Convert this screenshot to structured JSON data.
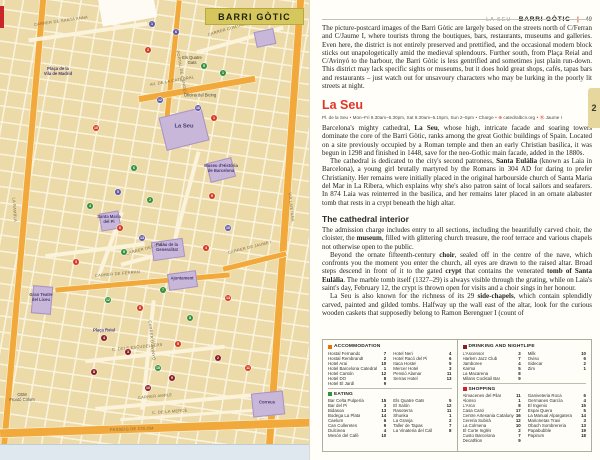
{
  "header": {
    "section": "LA SEU",
    "chapter": "BARRI GÒTIC",
    "divider": "|",
    "page_number": "49"
  },
  "chapter_tab": "2",
  "map": {
    "banner": "BARRI GÒTIC",
    "colors": {
      "acc": "#d6391f",
      "eat": "#35903b",
      "drink": "#8c1d25",
      "shop": "#5f58a6"
    },
    "roads": [
      {
        "x": 20,
        "y": -10,
        "w": 6,
        "h": 480,
        "r": 5,
        "c": "o"
      },
      {
        "x": 281,
        "y": -10,
        "w": 7,
        "h": 480,
        "r": 4,
        "c": "o"
      },
      {
        "x": 170,
        "y": 0,
        "w": 5,
        "h": 130,
        "r": 6,
        "c": "o"
      },
      {
        "x": 0,
        "y": 424,
        "w": 310,
        "h": 8,
        "r": -2,
        "c": "o"
      },
      {
        "x": 138,
        "y": 86,
        "w": 118,
        "h": 6,
        "r": -10,
        "c": "o"
      },
      {
        "x": 55,
        "y": 280,
        "w": 175,
        "h": 4.5,
        "r": -5,
        "c": "o"
      },
      {
        "x": 222,
        "y": 259,
        "w": 65,
        "h": 4.5,
        "r": -14,
        "c": "o"
      },
      {
        "x": 28,
        "y": 30,
        "w": 120,
        "h": 4,
        "r": -8,
        "c": "w"
      },
      {
        "x": 195,
        "y": 38,
        "w": 90,
        "h": 4,
        "r": -16,
        "c": "w"
      },
      {
        "x": 45,
        "y": 248,
        "w": 100,
        "h": 3.5,
        "r": -7,
        "c": "w"
      },
      {
        "x": 146,
        "y": 300,
        "w": 3.5,
        "h": 110,
        "r": 6,
        "c": "w"
      },
      {
        "x": 85,
        "y": 352,
        "w": 140,
        "h": 3.5,
        "r": -6,
        "c": "w"
      },
      {
        "x": 95,
        "y": 400,
        "w": 160,
        "h": 3.5,
        "r": -5,
        "c": "w"
      },
      {
        "x": 108,
        "y": 210,
        "w": 3.5,
        "h": 70,
        "r": 20,
        "c": "w"
      },
      {
        "x": 120,
        "y": 255,
        "w": 60,
        "h": 3.5,
        "r": -15,
        "c": "w"
      },
      {
        "x": 185,
        "y": 150,
        "w": 3.5,
        "h": 90,
        "r": 15,
        "c": "w"
      },
      {
        "x": 120,
        "y": 413,
        "w": 150,
        "h": 3,
        "r": -4,
        "c": "w"
      }
    ],
    "landmark_blocks": [
      {
        "x": 162,
        "y": 112,
        "w": 42,
        "h": 32,
        "r": -14
      },
      {
        "x": 152,
        "y": 240,
        "w": 30,
        "h": 17,
        "r": -8
      },
      {
        "x": 168,
        "y": 272,
        "w": 27,
        "h": 15,
        "r": -8
      },
      {
        "x": 32,
        "y": 286,
        "w": 18,
        "h": 26,
        "r": 5
      },
      {
        "x": 208,
        "y": 160,
        "w": 24,
        "h": 18,
        "r": -14
      },
      {
        "x": 100,
        "y": 212,
        "w": 18,
        "h": 16,
        "r": -10
      },
      {
        "x": 252,
        "y": 392,
        "w": 30,
        "h": 22,
        "r": -6
      },
      {
        "x": 255,
        "y": 30,
        "w": 18,
        "h": 14,
        "r": -12
      }
    ],
    "street_labels": [
      {
        "t": "CARRER DE SANTA ANNA",
        "x": 34,
        "y": 22,
        "r": -8
      },
      {
        "t": "CARRER COMTAL",
        "x": 208,
        "y": 32,
        "r": -16
      },
      {
        "t": "AV. DE LA CATEDRAL",
        "x": 150,
        "y": 82,
        "r": -10
      },
      {
        "t": "PORTAL DE L'ÀNGEL",
        "x": 178,
        "y": 48,
        "r": 80
      },
      {
        "t": "VIA LAIETANA",
        "x": 290,
        "y": 190,
        "r": 84
      },
      {
        "t": "LA RAMBLA",
        "x": 14,
        "y": 195,
        "r": 86
      },
      {
        "t": "CARRER DE FERRAN",
        "x": 95,
        "y": 273,
        "r": -5
      },
      {
        "t": "CARRER DE JAUME I",
        "x": 228,
        "y": 250,
        "r": -14
      },
      {
        "t": "CARRER D'AVINYÓ",
        "x": 150,
        "y": 318,
        "r": 84
      },
      {
        "t": "C. DELS ESCUDELLERS",
        "x": 112,
        "y": 347,
        "r": -6
      },
      {
        "t": "CARRER AMPLE",
        "x": 138,
        "y": 395,
        "r": -5
      },
      {
        "t": "C. DE LA MERCÈ",
        "x": 152,
        "y": 410,
        "r": -4
      },
      {
        "t": "CARRER DEL CALL",
        "x": 126,
        "y": 251,
        "r": -15
      },
      {
        "t": "PASSEIG DE COLOM",
        "x": 110,
        "y": 427,
        "r": -2
      }
    ],
    "poi_labels": [
      {
        "t": "La Seu",
        "x": 184,
        "y": 127,
        "cls": "poi-big"
      },
      {
        "t": "Palau de la\nGeneralitat",
        "x": 167,
        "y": 248
      },
      {
        "t": "Ajuntament",
        "x": 182,
        "y": 279
      },
      {
        "t": "Gran Teatre\ndel Liceu",
        "x": 41,
        "y": 298
      },
      {
        "t": "Museu d'Història\nde Barcelona",
        "x": 221,
        "y": 169
      },
      {
        "t": "Santa Maria\ndel Pi",
        "x": 109,
        "y": 220
      },
      {
        "t": "Plaça Reial",
        "x": 104,
        "y": 331
      },
      {
        "t": "Correus",
        "x": 267,
        "y": 403
      },
      {
        "t": "Plaça de la\nVila de Madrid",
        "x": 58,
        "y": 72
      },
      {
        "t": "Els Quatre\nGats",
        "x": 192,
        "y": 61,
        "cls": "poi-plain"
      },
      {
        "t": "Oficina del Bicing",
        "x": 200,
        "y": 96,
        "cls": "poi-plain"
      },
      {
        "t": "CEM\nFrontó Colom",
        "x": 22,
        "y": 398,
        "cls": "poi-plain"
      }
    ],
    "markers": [
      {
        "n": "1",
        "x": 152,
        "y": 24,
        "c": "shop"
      },
      {
        "n": "6",
        "x": 176,
        "y": 32,
        "c": "shop"
      },
      {
        "n": "2",
        "x": 148,
        "y": 50,
        "c": "acc"
      },
      {
        "n": "5",
        "x": 204,
        "y": 66,
        "c": "eat"
      },
      {
        "n": "1",
        "x": 223,
        "y": 73,
        "c": "eat"
      },
      {
        "n": "12",
        "x": 160,
        "y": 100,
        "c": "shop"
      },
      {
        "n": "10",
        "x": 96,
        "y": 128,
        "c": "acc"
      },
      {
        "n": "1",
        "x": 214,
        "y": 118,
        "c": "acc"
      },
      {
        "n": "16",
        "x": 198,
        "y": 108,
        "c": "shop"
      },
      {
        "n": "6",
        "x": 134,
        "y": 168,
        "c": "eat"
      },
      {
        "n": "4",
        "x": 90,
        "y": 206,
        "c": "eat"
      },
      {
        "n": "5",
        "x": 118,
        "y": 192,
        "c": "shop"
      },
      {
        "n": "2",
        "x": 150,
        "y": 200,
        "c": "eat"
      },
      {
        "n": "9",
        "x": 212,
        "y": 196,
        "c": "acc"
      },
      {
        "n": "13",
        "x": 142,
        "y": 238,
        "c": "shop"
      },
      {
        "n": "6",
        "x": 120,
        "y": 228,
        "c": "acc"
      },
      {
        "n": "9",
        "x": 124,
        "y": 252,
        "c": "eat"
      },
      {
        "n": "4",
        "x": 206,
        "y": 248,
        "c": "acc"
      },
      {
        "n": "10",
        "x": 228,
        "y": 228,
        "c": "shop"
      },
      {
        "n": "7",
        "x": 163,
        "y": 290,
        "c": "eat"
      },
      {
        "n": "3",
        "x": 76,
        "y": 262,
        "c": "acc"
      },
      {
        "n": "8",
        "x": 140,
        "y": 308,
        "c": "acc"
      },
      {
        "n": "12",
        "x": 108,
        "y": 300,
        "c": "eat"
      },
      {
        "n": "4",
        "x": 104,
        "y": 338,
        "c": "drink"
      },
      {
        "n": "3",
        "x": 128,
        "y": 352,
        "c": "drink"
      },
      {
        "n": "8",
        "x": 190,
        "y": 318,
        "c": "eat"
      },
      {
        "n": "5",
        "x": 178,
        "y": 344,
        "c": "acc"
      },
      {
        "n": "13",
        "x": 228,
        "y": 298,
        "c": "acc"
      },
      {
        "n": "2",
        "x": 218,
        "y": 358,
        "c": "drink"
      },
      {
        "n": "9",
        "x": 172,
        "y": 378,
        "c": "drink"
      },
      {
        "n": "8",
        "x": 94,
        "y": 372,
        "c": "drink"
      },
      {
        "n": "15",
        "x": 158,
        "y": 368,
        "c": "eat"
      },
      {
        "n": "11",
        "x": 248,
        "y": 368,
        "c": "acc"
      },
      {
        "n": "10",
        "x": 148,
        "y": 388,
        "c": "drink"
      }
    ]
  },
  "article": {
    "intro": "The picture-postcard images of the Barri Gòtic are largely based on the streets north of C/Ferran and C/Jaume I, where tourists throng the boutiques, bars, restaurants, museums and galleries. Even here, the district is not entirely preserved and prettified, and the occasional modern block sticks out unapologetically amid the medieval splendours. Further south, from Plaça Reial and C/Avinyó to the harbour, the Barri Gòtic is less gentrified and sometimes just plain run-down. This district may lack specific sights or museums, but it does hold great shops, cafés, tapas bars and restaurants – just watch out for unsavoury characters who may be lurking in the poorly lit streets at night.",
    "heading": "La Seu",
    "info_line": [
      {
        "t": "Pl. de la Seu"
      },
      {
        "t": "Mon–Fri 9.30am–6.30pm, Sat 9.30am–5.15pm, Sun 2–5pm"
      },
      {
        "t": "Charge"
      },
      {
        "t": "catedralbcn.org",
        "icon": "⊕"
      },
      {
        "t": "Jaume I",
        "icon": "Ⓜ"
      }
    ],
    "paragraphs": [
      {
        "segments": [
          {
            "t": "Barcelona's mighty cathedral, "
          },
          {
            "t": "La Seu",
            "b": true
          },
          {
            "t": ", whose high, intricate facade and soaring towers dominate the core of the Barri Gòtic, ranks among the great Gothic buildings of Spain. Located on a site previously occupied by a Roman temple and then an early Christian basilica, it was begun in 1298 and finished in 1448, save for the neo-Gothic main facade, added in the 1880s."
          }
        ]
      },
      {
        "segments": [
          {
            "t": "The cathedral is dedicated to the city's second patroness, "
          },
          {
            "t": "Santa Eulàlia",
            "b": true
          },
          {
            "t": " (known as Laia in Barcelona), a young girl brutally martyred by the Romans in 304 AD for daring to prefer Christianity. Her remains were initially placed in the original harbourside church of Santa Maria del Mar in La Ribera, which explains why she's also patron saint of local sailors and seafarers. In 874 Laia was reinterred in the basilica, and her remains later placed in an ornate alabaster tomb that rests in a crypt beneath the high altar."
          }
        ]
      }
    ],
    "subheading": "The cathedral interior",
    "interior_paragraphs": [
      {
        "segments": [
          {
            "t": "The admission charge includes entry to all sections, including the beautifully carved choir, the cloister, the "
          },
          {
            "t": "museum",
            "b": true
          },
          {
            "t": ", filled with glittering church treasure, the roof terrace and various chapels not otherwise open to the public."
          }
        ]
      },
      {
        "segments": [
          {
            "t": "Beyond the ornate fifteenth-century "
          },
          {
            "t": "choir",
            "b": true
          },
          {
            "t": ", sealed off in the centre of the nave, which confronts you the moment you enter the church, all eyes are drawn to the raised altar. Broad steps descend in front of it to the gated "
          },
          {
            "t": "crypt",
            "b": true
          },
          {
            "t": " that contains the venerated "
          },
          {
            "t": "tomb of Santa Eulàlia",
            "b": true
          },
          {
            "t": ". The marble tomb itself (1327–29) is always visible through the grating, while on Laia's saint's day, February 12, the crypt is thrown open for visits and a choir sings in her honour."
          }
        ]
      },
      {
        "segments": [
          {
            "t": "La Seu is also known for the richness of its 29 "
          },
          {
            "t": "side-chapels",
            "b": true
          },
          {
            "t": ", which contain splendidly carved, painted and gilded tombs. Halfway up the wall east of the altar, look for the curious wooden caskets that supposedly belong to Ramon Berenguer I (count of"
          }
        ]
      }
    ]
  },
  "listings": {
    "left": [
      {
        "title": "ACCOMMODATION",
        "color": "#e87200",
        "cols": [
          [
            [
              "Hostal Fernando",
              "7"
            ],
            [
              "Hostal Rembrandt",
              "2"
            ],
            [
              "Hotel Arai",
              "10"
            ],
            [
              "Hotel Barcelona Catedral",
              "1"
            ],
            [
              "Hotel Cantón",
              "12"
            ],
            [
              "Hotel DO",
              "8"
            ],
            [
              "Hotel El Jardí",
              "9"
            ]
          ],
          [
            [
              "Hotel Neri",
              "4"
            ],
            [
              "Hotel Racó del Pi",
              "6"
            ],
            [
              "Itaca Hostel",
              "5"
            ],
            [
              "Mercer Hotel",
              "3"
            ],
            [
              "Pensió Alamar",
              "11"
            ],
            [
              "Serras Hotel",
              "13"
            ]
          ]
        ]
      },
      {
        "title": "EATING",
        "color": "#35903b",
        "cols": [
          [
            [
              "Bar Celta Pulpería",
              "15"
            ],
            [
              "Bar del Pi",
              "3"
            ],
            [
              "Bidasoa",
              "13"
            ],
            [
              "Bodega La Plata",
              "14"
            ],
            [
              "Caelum",
              "6"
            ],
            [
              "Can Culleretes",
              "9"
            ],
            [
              "Dulcinea",
              "4"
            ],
            [
              "Mesón del Café",
              "10"
            ]
          ],
          [
            [
              "Els Quatre Gats",
              "5"
            ],
            [
              "El Salón",
              "12"
            ],
            [
              "Rasoterra",
              "11"
            ],
            [
              "Shunka",
              "1"
            ],
            [
              "La Granja",
              "2"
            ],
            [
              "Taller de Tapas",
              "7"
            ],
            [
              "La Vinateria del Call",
              "8"
            ]
          ]
        ]
      }
    ],
    "right": [
      {
        "title": "DRINKING AND NIGHTLIFE",
        "color": "#8c1d25",
        "cols": [
          [
            [
              "L'Ascensor",
              "3"
            ],
            [
              "Harlem Jazz Club",
              "7"
            ],
            [
              "Jamboree",
              "4"
            ],
            [
              "Karma",
              "5"
            ],
            [
              "La Macarena",
              "8"
            ],
            [
              "Milans Cocktail Bar",
              "9"
            ]
          ],
          [
            [
              "Milk",
              "10"
            ],
            [
              "Oviso",
              "6"
            ],
            [
              "Sidecar",
              "2"
            ],
            [
              "Zim",
              "1"
            ]
          ]
        ]
      },
      {
        "title": "SHOPPING",
        "color": "#d0202a",
        "cols": [
          [
            [
              "Almacenes del Pilar",
              "11"
            ],
            [
              "Alonso",
              "1"
            ],
            [
              "L'Arca",
              "8"
            ],
            [
              "Casa Carol",
              "17"
            ],
            [
              "Centre Artesania Catalunya",
              "16"
            ],
            [
              "Cereria Subirà",
              "12"
            ],
            [
              "La Colmena",
              "10"
            ],
            [
              "El Corte Inglés",
              "2"
            ],
            [
              "Custo Barcelona",
              "7"
            ],
            [
              "Decathlon",
              "9"
            ]
          ],
          [
            [
              "Ganiveteria Roca",
              "6"
            ],
            [
              "Germanes García",
              "4"
            ],
            [
              "El Ingenio",
              "15"
            ],
            [
              "Espai Quera",
              "5"
            ],
            [
              "La Manual Alpargatera",
              "14"
            ],
            [
              "Marionetas Travi",
              "3"
            ],
            [
              "Obach Sombrereria",
              "13"
            ],
            [
              "Papabubble",
              "19"
            ],
            [
              "Papirum",
              "18"
            ]
          ]
        ]
      }
    ]
  }
}
